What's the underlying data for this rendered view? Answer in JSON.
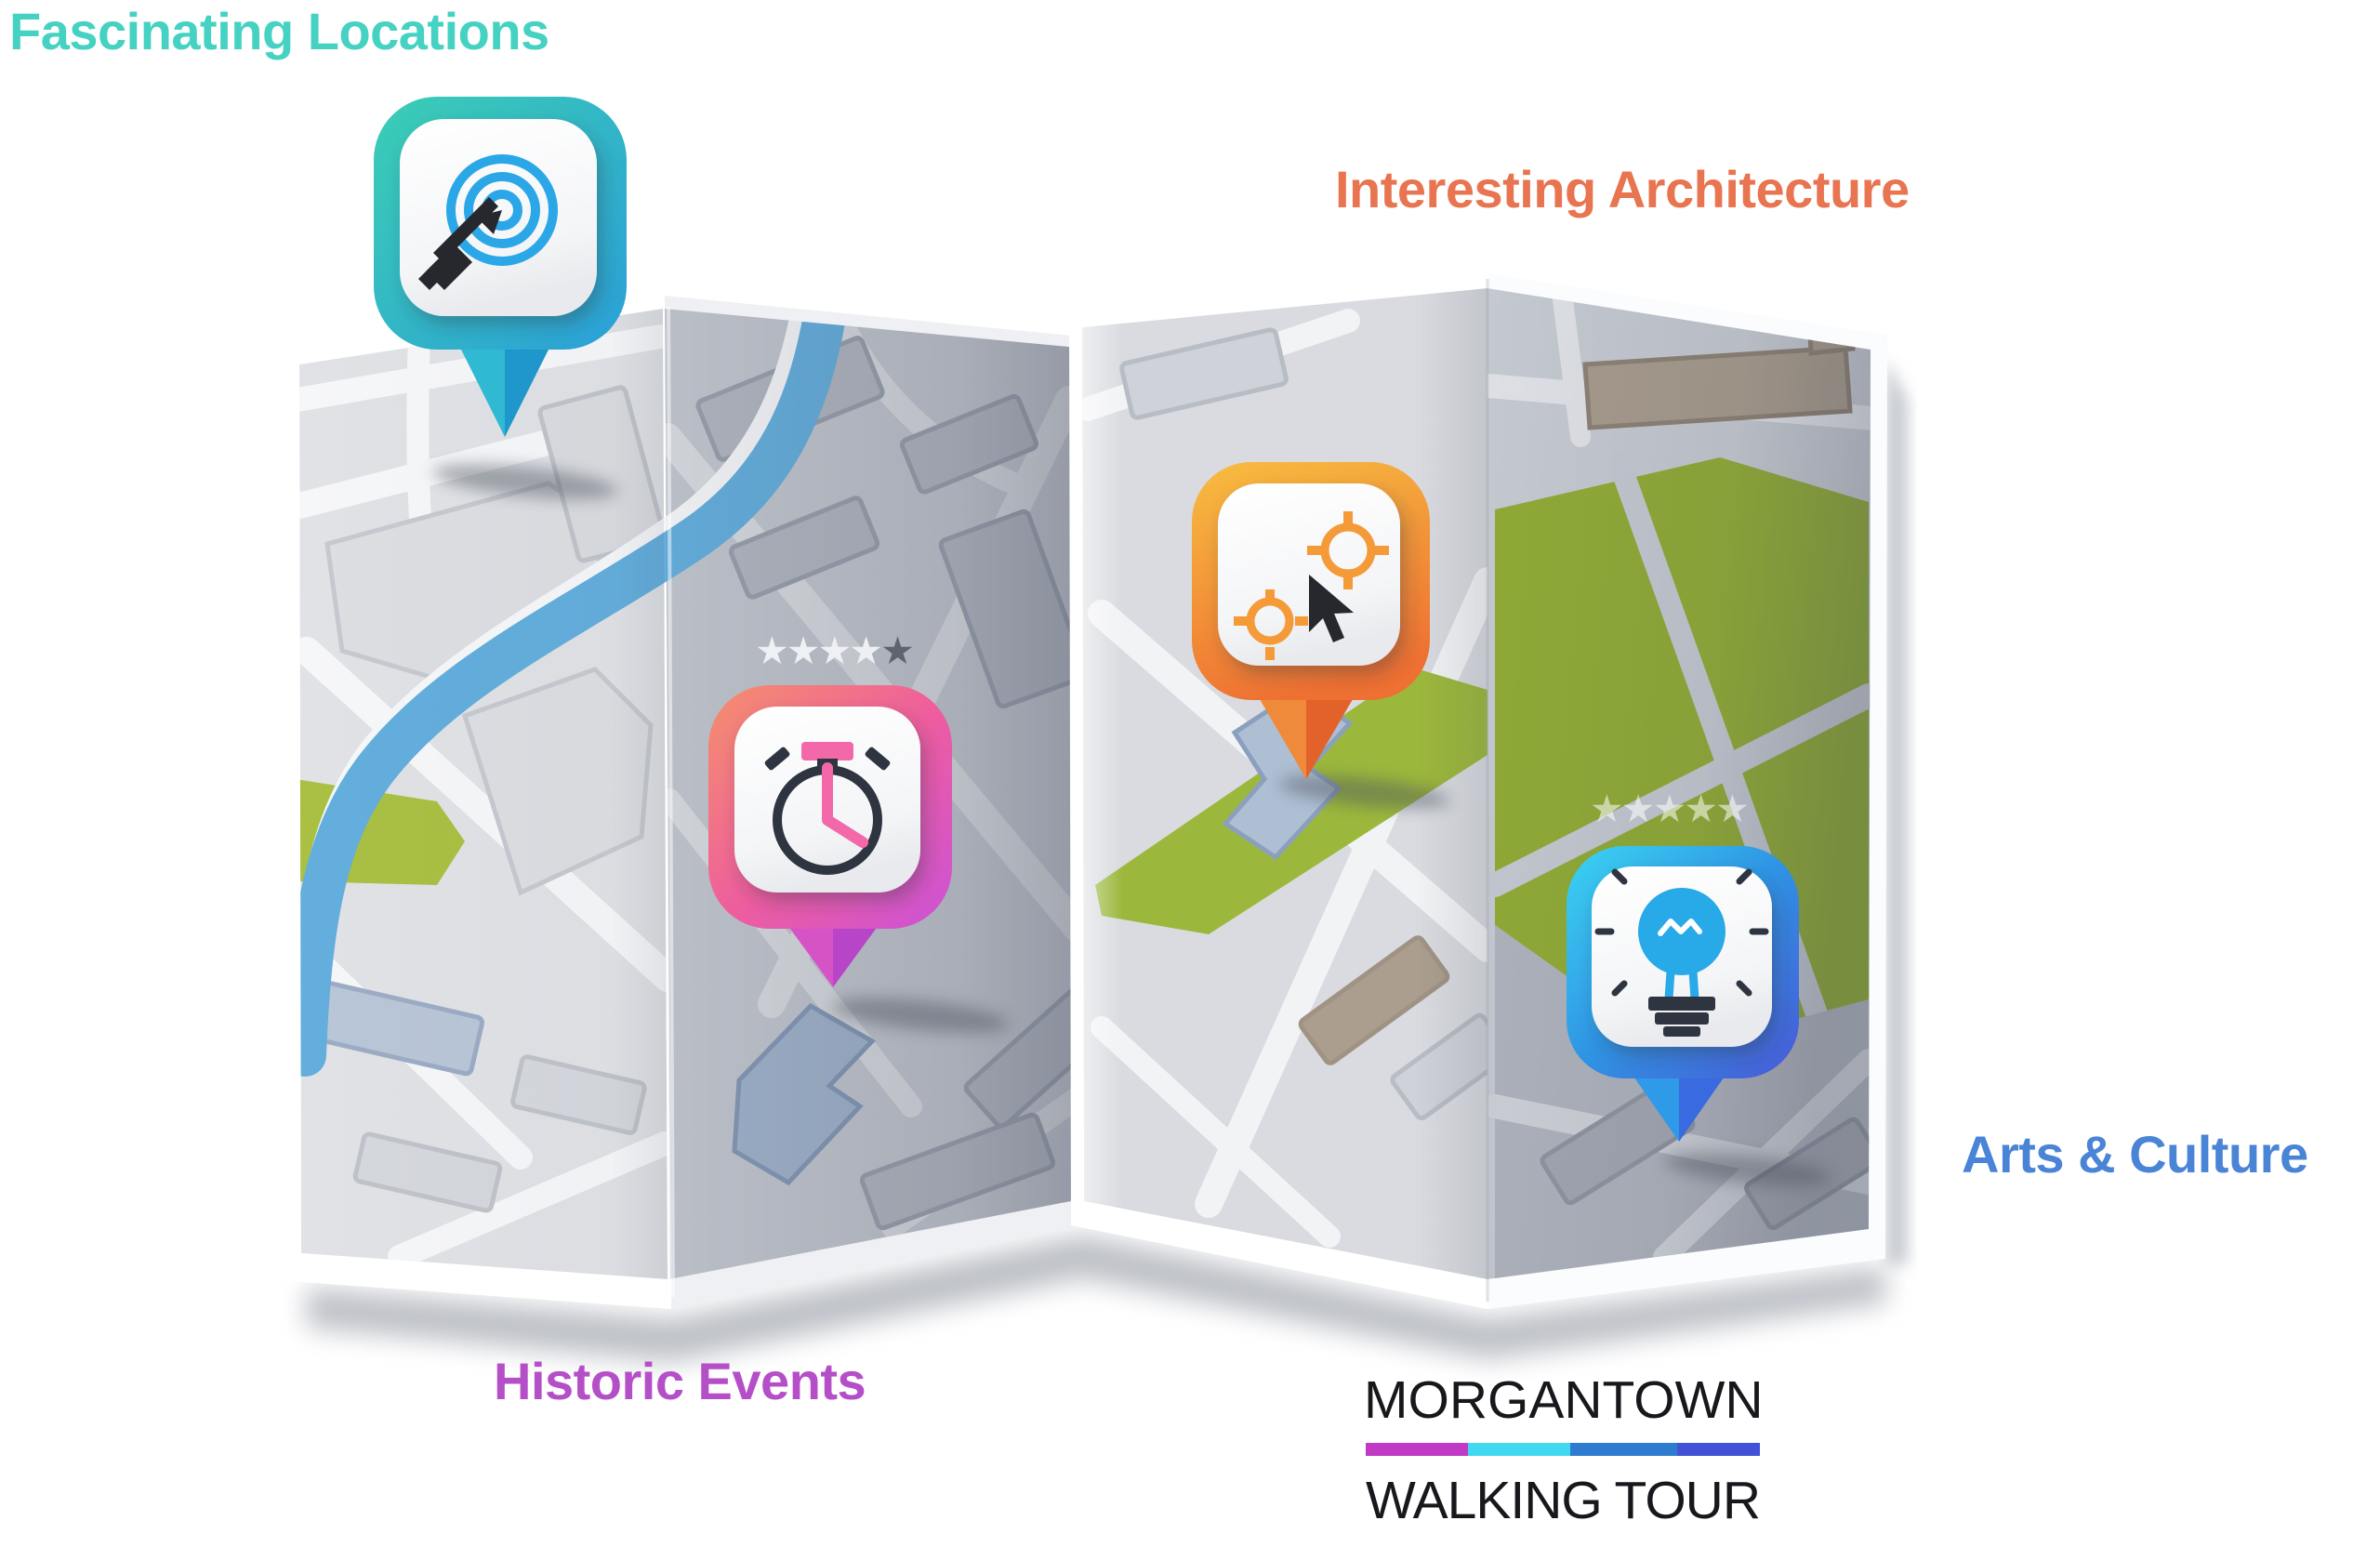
{
  "poster_title": {
    "line1": "MORGANTOWN",
    "line2": "WALKING TOUR"
  },
  "logo_bar": {
    "colors": [
      "#c13ac6",
      "#41d8f0",
      "#2e7ccf",
      "#4152d6"
    ]
  },
  "categories": [
    {
      "label": "Fascinating Locations",
      "color": "#45d2c2",
      "icon": "target-arrow-icon"
    },
    {
      "label": "Interesting Architecture",
      "color": "#e87450",
      "icon": "crosshair-cursor-icon"
    },
    {
      "label": "Historic Events",
      "color": "#b44fc8",
      "icon": "stopwatch-icon"
    },
    {
      "label": "Arts & Culture",
      "color": "#4a84d6",
      "icon": "lightbulb-icon"
    }
  ],
  "pins": {
    "teal": {
      "top": "#3bceb4",
      "bottom": "#2a9fd8",
      "tail_light": "#2fb9d2",
      "tail_dark": "#1f96cc"
    },
    "orange": {
      "top": "#f7bb40",
      "bottom": "#ee7032",
      "tail_light": "#ef8a3a",
      "tail_dark": "#e2622a"
    },
    "pink": {
      "top": "#f58f6c",
      "mid": "#ee5d9e",
      "bottom": "#cb52d8",
      "tail_light": "#d653c6",
      "tail_dark": "#b845c8"
    },
    "blue": {
      "top": "#3bd4f2",
      "mid": "#2f93e4",
      "bottom": "#4a59d6",
      "tail_light": "#2f9ae8",
      "tail_dark": "#3a6ae0"
    }
  },
  "ratings": {
    "historic": {
      "stars": 5,
      "star_colors": [
        "#eef0f4",
        "#eef0f4",
        "#eef0f4",
        "#eef0f4",
        "#5d6470"
      ]
    },
    "arts": {
      "stars": 5,
      "star_colors": [
        "rgba(255,255,255,0.55)",
        "rgba(255,255,255,0.55)",
        "rgba(255,255,255,0.55)",
        "rgba(255,255,255,0.55)",
        "rgba(255,255,255,0.55)"
      ]
    }
  },
  "map_colors": {
    "water": "#63aedd",
    "park": "#9cb83c",
    "park_large": "#93af34",
    "park_light": "#a9c043",
    "sand": "#ab9e8e",
    "sand_outline": "#8f8375"
  },
  "icon_colors": {
    "target": "#2ba7e8",
    "crosshair": "#f59a38",
    "ring_dark": "#2e3440",
    "hand_pink": "#f268a8",
    "bulb_blue": "#28a9e8",
    "dark": "#26282e"
  }
}
